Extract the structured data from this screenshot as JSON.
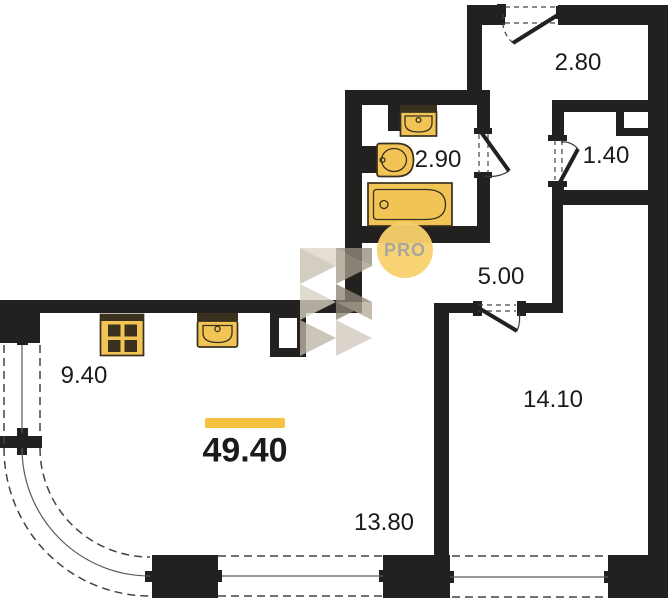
{
  "floorplan": {
    "total_area_label": "49.40",
    "watermark_text": "PRO",
    "rooms": [
      {
        "name": "entry-hall",
        "area_label": "2.80"
      },
      {
        "name": "bathroom",
        "area_label": "2.90"
      },
      {
        "name": "wardrobe",
        "area_label": "1.40"
      },
      {
        "name": "hallway",
        "area_label": "5.00"
      },
      {
        "name": "kitchen",
        "area_label": "9.40"
      },
      {
        "name": "bedroom",
        "area_label": "14.10"
      },
      {
        "name": "living-room",
        "area_label": "13.80"
      }
    ],
    "colors": {
      "wall": "#23211f",
      "fixture_fill": "#f1c455",
      "fixture_outline": "#39301d",
      "accent_bar": "#f5c23f",
      "watermark_circle": "#f7d16d",
      "watermark_text": "#a6a299",
      "label_text": "#1b1b1a",
      "dash_line": "#45433f"
    }
  }
}
